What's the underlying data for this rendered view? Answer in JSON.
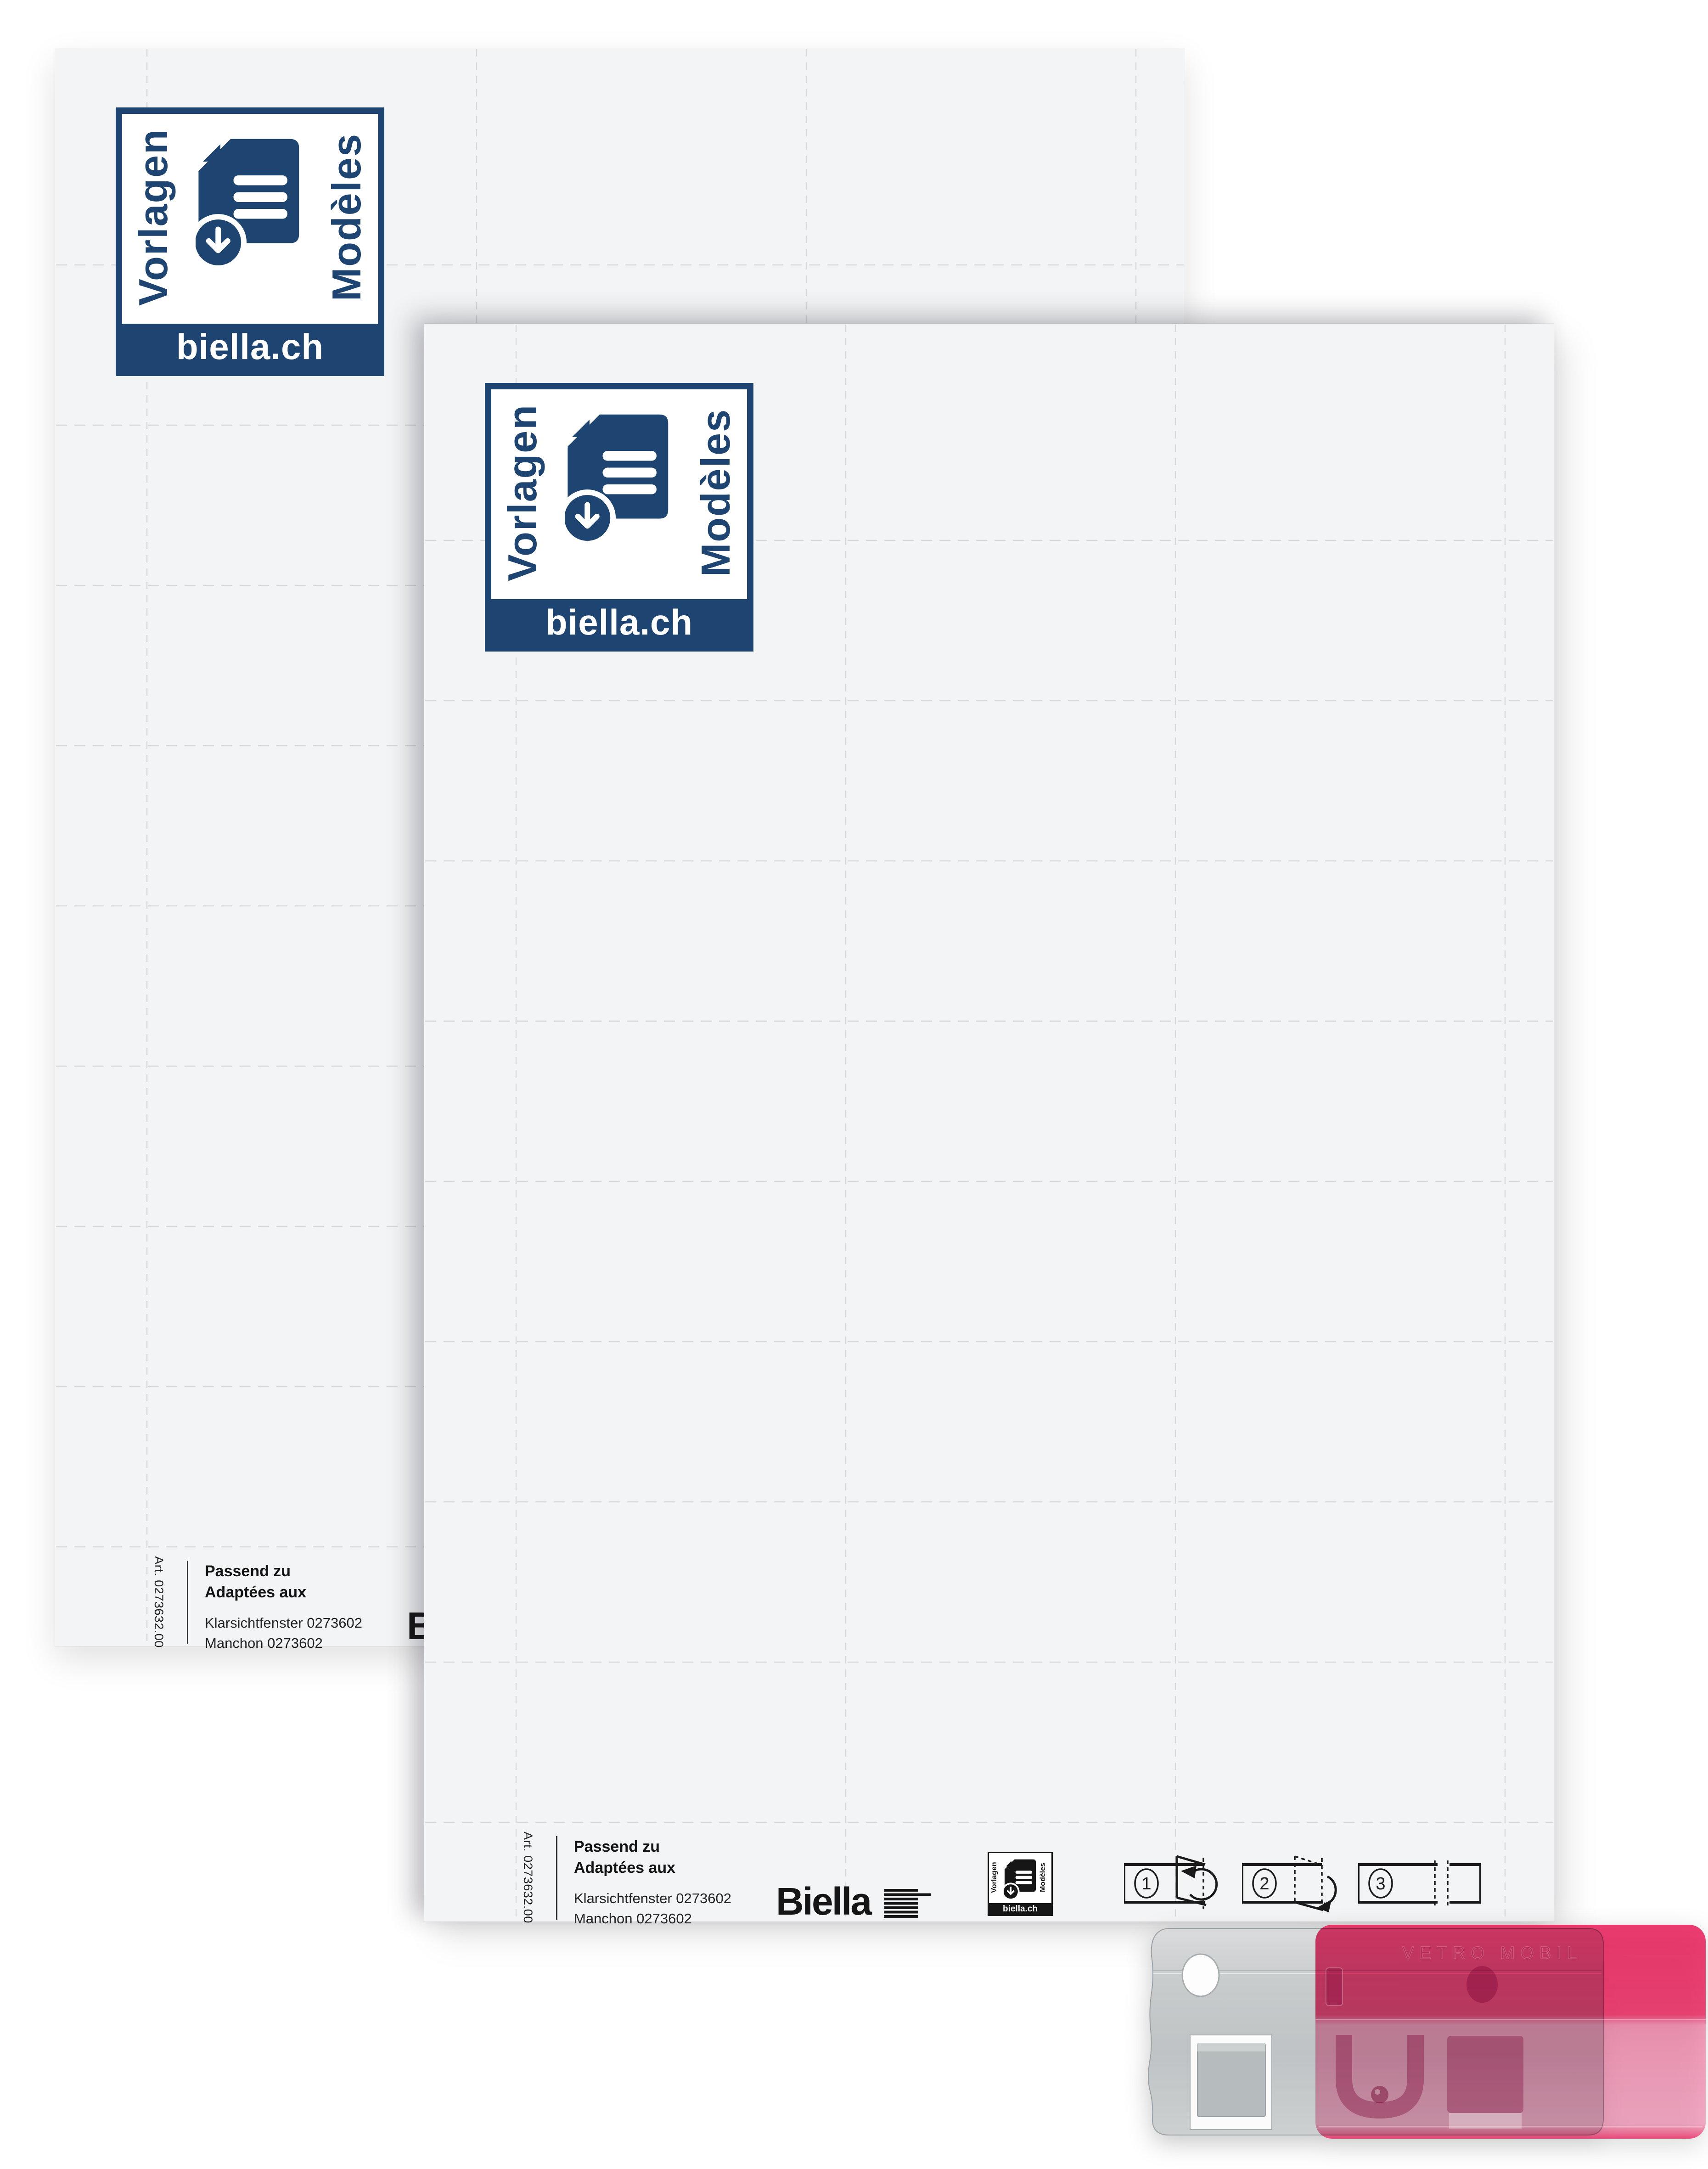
{
  "product": {
    "badge": {
      "left": "Vorlagen",
      "right": "Modèles",
      "site": "biella.ch"
    },
    "strip": {
      "art": "Art. 0273632.00",
      "fit_de": "Passend zu",
      "fit_fr": "Adaptées aux",
      "item_de": "Klarsichtfenster 0273602",
      "item_fr": "Manchon 0273602",
      "brand": "Biella",
      "steps": [
        "1",
        "2",
        "3"
      ]
    },
    "clip": {
      "embossed": "VETRO MOBIL"
    }
  },
  "colors": {
    "logo_blue": "#1e4571",
    "ink": "#1b1b1b",
    "sheet_gray": "#f3f4f5",
    "grid_gray": "#d6d8da",
    "pink": "#e81a56",
    "metal_gray": "#c6c9cb"
  }
}
